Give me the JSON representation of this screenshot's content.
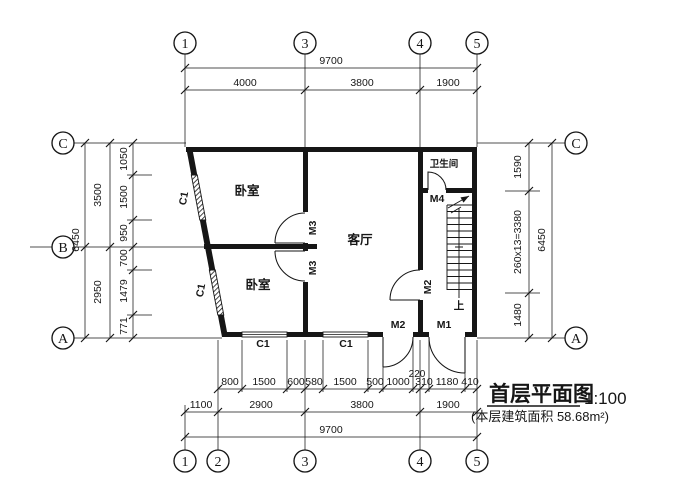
{
  "title": {
    "text": "首层平面图",
    "scale": "1:100",
    "area_note": "(本层建筑面积 58.68m²)"
  },
  "axes": {
    "top": [
      "1",
      "3",
      "4",
      "5"
    ],
    "bottom": [
      "1",
      "2",
      "3",
      "4",
      "5"
    ],
    "left": [
      "C",
      "B",
      "A"
    ],
    "right": [
      "C",
      "A"
    ]
  },
  "dims": {
    "top": {
      "overall": "9700",
      "segments": [
        "4000",
        "3800",
        "1900"
      ]
    },
    "bottom": {
      "detail": [
        "800",
        "1500",
        "600",
        "580",
        "1500",
        "500",
        "1000",
        "220",
        "310",
        "1180",
        "410"
      ],
      "mid": [
        "1100",
        "2900",
        "3800",
        "1900"
      ],
      "overall": "9700"
    },
    "left": {
      "detail": [
        "1050",
        "1500",
        "950",
        "700",
        "1479",
        "771"
      ],
      "mid": [
        "3500",
        "2950"
      ],
      "overall": "6450"
    },
    "right": {
      "detail": [
        "1590",
        "260x13=3380",
        "1480"
      ],
      "overall": "6450"
    }
  },
  "rooms": {
    "bedroom_upper": "卧室",
    "bedroom_lower": "卧室",
    "living_room": "客厅",
    "bathroom": "卫生间"
  },
  "openings": {
    "window_label": "C1",
    "door_m1": "M1",
    "door_m2": "M2",
    "door_m3": "M3",
    "door_m4": "M4"
  },
  "stair": {
    "up_label": "上"
  }
}
